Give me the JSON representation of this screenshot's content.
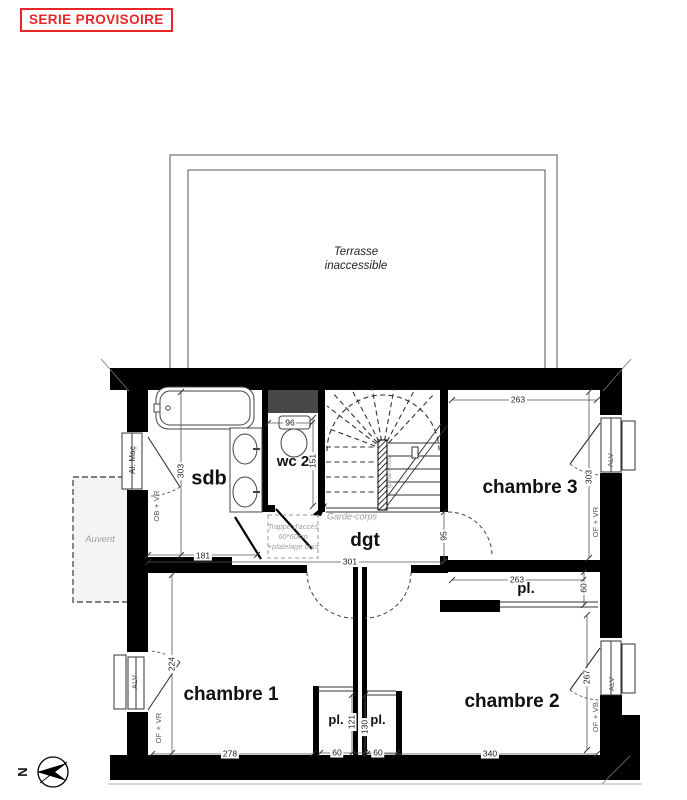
{
  "stamp": {
    "text": "SERIE PROVISOIRE",
    "color": "#e8262a"
  },
  "terrasse": {
    "line1": "Terrasse",
    "line2": "inaccessible"
  },
  "rooms": {
    "sdb": "sdb",
    "wc": "wc 2",
    "dgt": "dgt",
    "chambre1": "chambre 1",
    "chambre2": "chambre 2",
    "chambre3": "chambre 3",
    "placard_ch3": "pl.",
    "placard_1": "pl.",
    "placard_2": "pl."
  },
  "annotations": {
    "auvent": "Auvent",
    "garde_corps": "Garde-corps",
    "garde_corps_vertical": "garde-corps",
    "trappe_line1": "Trappe d'accès",
    "trappe_line2": "60*60cm",
    "trappe_line3": "+platelage bois",
    "north": "N"
  },
  "windows": {
    "sdb_frame": "Al. Maç",
    "sdb_type": "OB + VR",
    "ch1_sill": "ALV",
    "ch1_type": "OF + VR",
    "ch3_sill": "ALV",
    "ch3_type": "OF + VR",
    "ch2_sill": "ALV",
    "ch2_type": "OF + VB"
  },
  "dimensions": {
    "sdb_width": "181",
    "sdb_depth": "303",
    "wc_width": "96",
    "wc_depth": "151",
    "dgt_width": "301",
    "dgt_depth": "95",
    "ch3_width": "263",
    "ch3_depth": "303",
    "pl_ch3_width": "263",
    "pl_ch3_depth": "60",
    "ch1_width": "278",
    "ch1_depth": "224",
    "ch2_width": "340",
    "ch2_depth": "267",
    "pl1_depth": "121",
    "pl1_width": "60",
    "pl2_depth": "130",
    "pl2_width": "60"
  }
}
